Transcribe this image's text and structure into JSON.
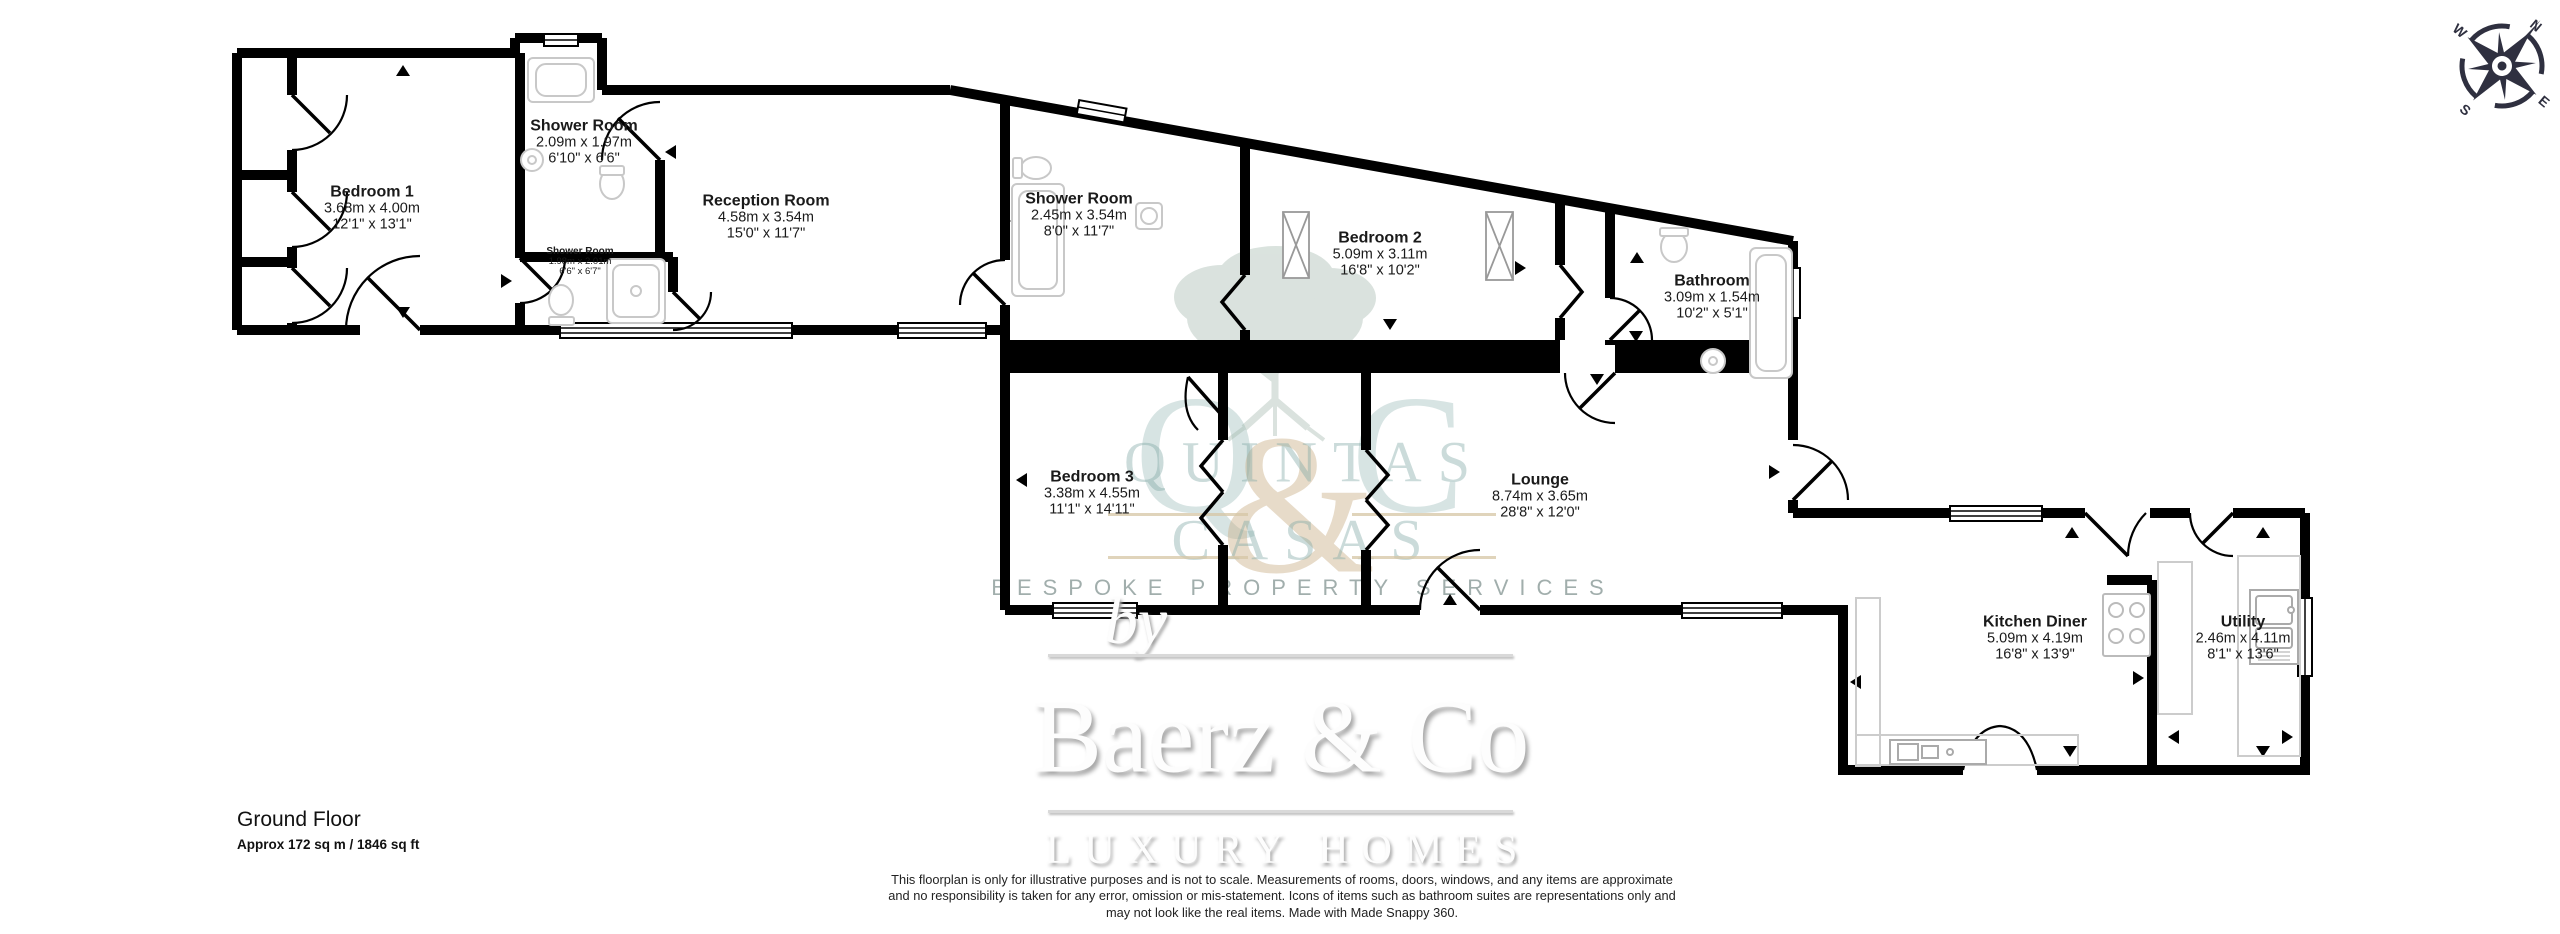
{
  "colors": {
    "wall": "#000000",
    "fixture_outline": "#c8c8c8",
    "watermark_teal": "#7ea7a4",
    "watermark_gold": "#cbb089",
    "compass": "#2f3040"
  },
  "compass": {
    "n": "N",
    "e": "E",
    "s": "S",
    "w": "W"
  },
  "plan": {
    "rooms": [
      {
        "name": "Bedroom 1",
        "metric": "3.68m x 4.00m",
        "imperial": "12'1\" x 13'1\""
      },
      {
        "name": "Shower Room",
        "metric": "2.09m x 1.97m",
        "imperial": "6'10\" x 6'6\""
      },
      {
        "name": "Shower Room",
        "metric": "1.98m x 2.01m",
        "imperial": "6'6\" x 6'7\""
      },
      {
        "name": "Reception Room",
        "metric": "4.58m x 3.54m",
        "imperial": "15'0\" x 11'7\""
      },
      {
        "name": "Shower Room",
        "metric": "2.45m x 3.54m",
        "imperial": "8'0\" x 11'7\""
      },
      {
        "name": "Bedroom 2",
        "metric": "5.09m x 3.11m",
        "imperial": "16'8\" x 10'2\""
      },
      {
        "name": "Bathroom",
        "metric": "3.09m x 1.54m",
        "imperial": "10'2\" x 5'1\""
      },
      {
        "name": "Bedroom 3",
        "metric": "3.38m x 4.55m",
        "imperial": "11'1\" x 14'11\""
      },
      {
        "name": "Lounge",
        "metric": "8.74m x 3.65m",
        "imperial": "28'8\" x 12'0\""
      },
      {
        "name": "Kitchen Diner",
        "metric": "5.09m x 4.19m",
        "imperial": "16'8\" x 13'9\""
      },
      {
        "name": "Utility",
        "metric": "2.46m x 4.11m",
        "imperial": "8'1\" x 13'6\""
      }
    ]
  },
  "watermark": {
    "monogram_q": "Q",
    "monogram_amp": "&",
    "monogram_c": "C",
    "word1": "QUINTAS",
    "word2": "CASAS",
    "tagline": "BESPOKE PROPERTY SERVICES",
    "by": "by",
    "brand": "Baerz & Co",
    "brand_tagline": "LUXURY HOMES"
  },
  "footer": {
    "floor_label": "Ground Floor",
    "area_label": "Approx 172 sq m / 1846 sq ft"
  },
  "disclaimer": {
    "line1": "This floorplan is only for illustrative purposes and is not to scale. Measurements of rooms, doors, windows, and any items are approximate",
    "line2": "and no responsibility is taken for any error, omission or mis-statement. Icons of items such as bathroom suites are representations only and",
    "line3": "may not look like the real items. Made with Made Snappy 360."
  }
}
